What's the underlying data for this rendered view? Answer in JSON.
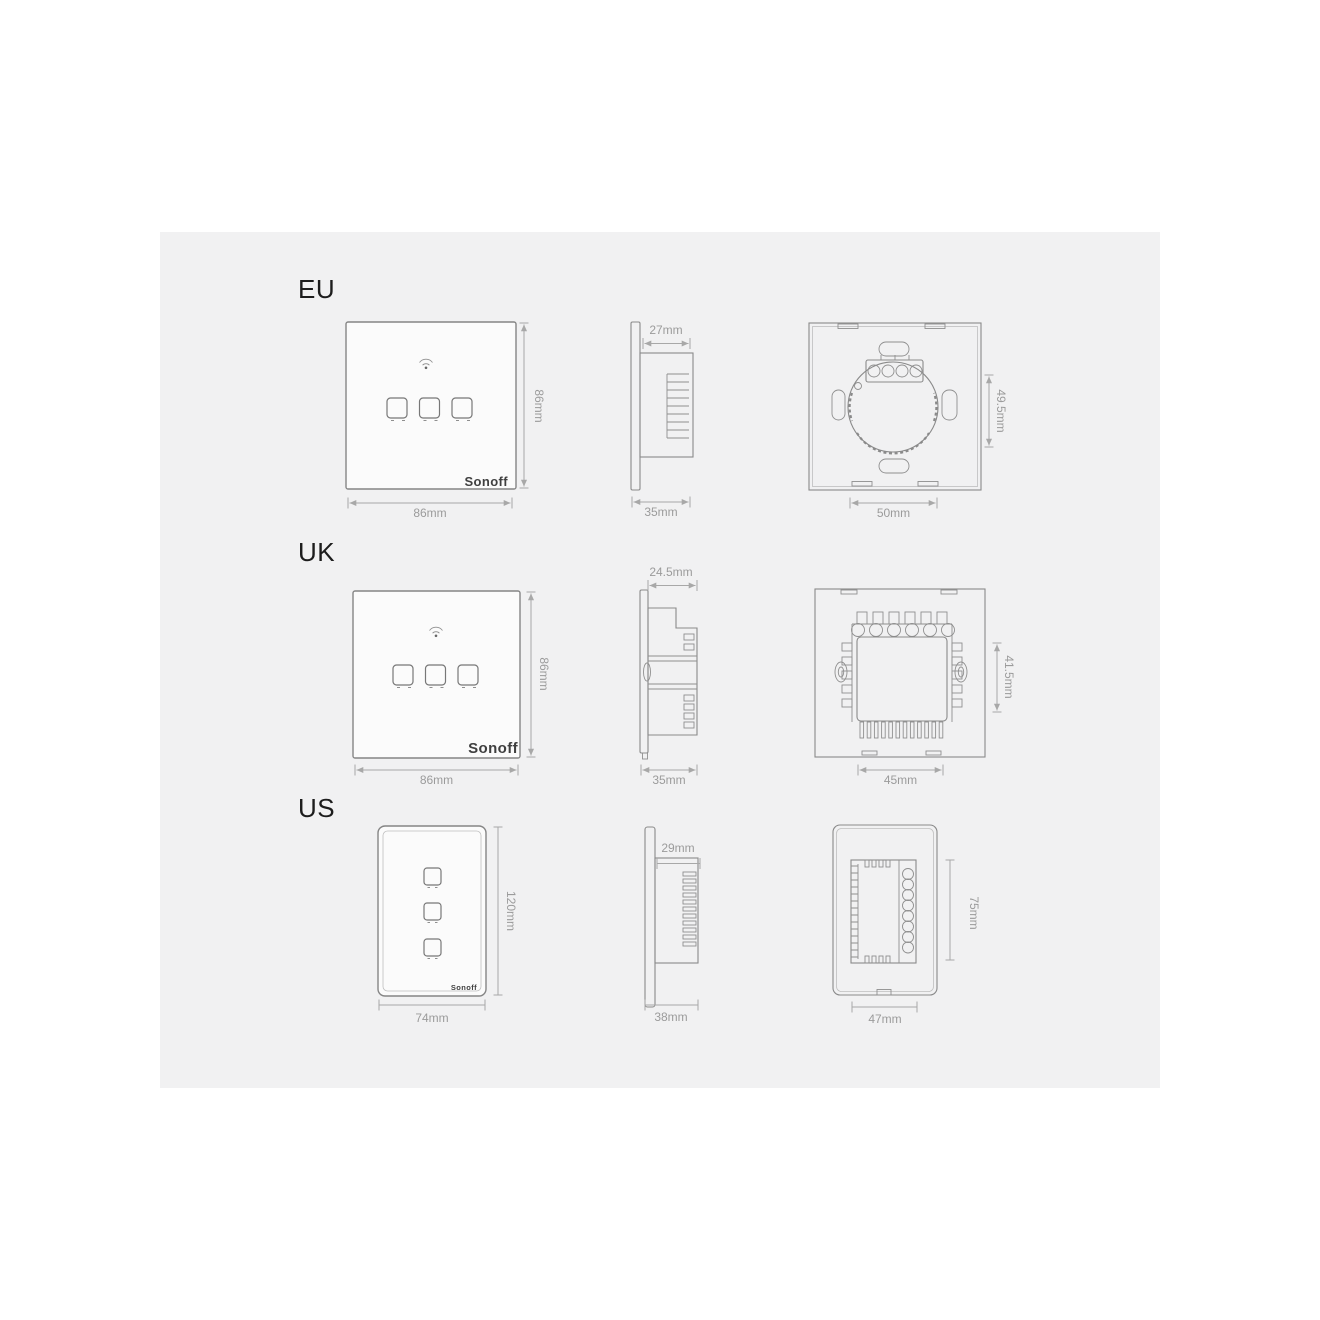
{
  "colors": {
    "page_bg": "#ffffff",
    "canvas_bg": "#f1f1f2",
    "line": "#8a8a8a",
    "dimension_line": "#a8a8a8",
    "dimension_text": "#9b9b9b",
    "label_text": "#1d1d1d",
    "panel_fill": "#fbfbfb",
    "brand_text": "#3f3f3f"
  },
  "regions": [
    {
      "label": "EU",
      "brand": "Sonoff",
      "front": {
        "width": "86mm",
        "height": "86mm",
        "buttons": 3
      },
      "side": {
        "depth_body": "27mm",
        "depth_total": "35mm"
      },
      "back": {
        "height": "49.5mm",
        "width": "50mm"
      }
    },
    {
      "label": "UK",
      "brand": "Sonoff",
      "front": {
        "width": "86mm",
        "height": "86mm",
        "buttons": 3
      },
      "side": {
        "depth_body": "24.5mm",
        "depth_total": "35mm"
      },
      "back": {
        "height": "41.5mm",
        "width": "45mm"
      }
    },
    {
      "label": "US",
      "brand": "Sonoff",
      "front": {
        "width": "74mm",
        "height": "120mm",
        "buttons": 3
      },
      "side": {
        "depth_body": "29mm",
        "depth_total": "38mm"
      },
      "back": {
        "height": "75mm",
        "width": "47mm"
      }
    }
  ]
}
